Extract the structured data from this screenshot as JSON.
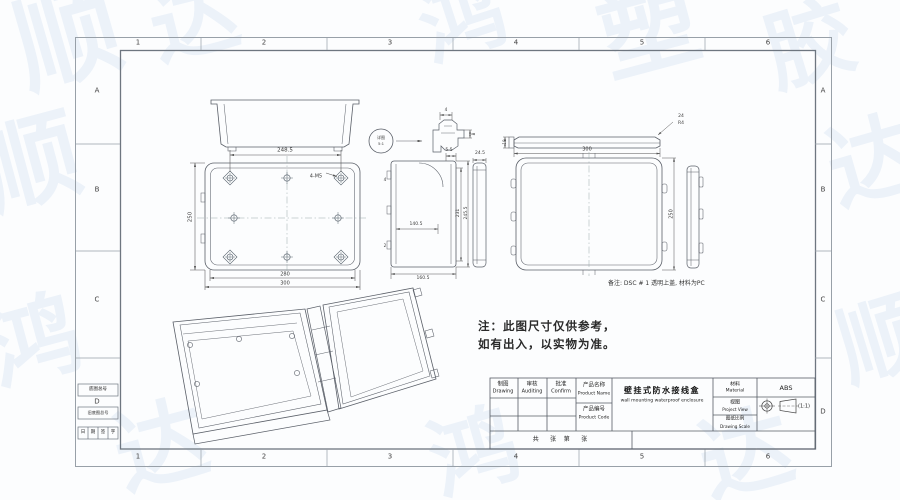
{
  "sheet": {
    "zone_columns": [
      "1",
      "2",
      "3",
      "4",
      "5",
      "6"
    ],
    "zone_rows": [
      "A",
      "B",
      "C",
      "D"
    ],
    "note": {
      "line1": "注：此图尺寸仅供参考，",
      "line2": "如有出入，以实物为准。"
    },
    "remark": "备注: DSC # 1 透明上盖, 材料为PC",
    "side_blocks": {
      "block1": "底图总号",
      "block2": "旧底图总号",
      "sign_row": [
        "日",
        "期",
        "签",
        "字"
      ]
    }
  },
  "title_block": {
    "drawing_cn": "制图",
    "drawing_en": "Drawing",
    "auditing_cn": "审核",
    "auditing_en": "Auditing",
    "confirm_cn": "批准",
    "confirm_en": "Confirm",
    "product_name_cn": "产品名称",
    "product_name_en": "Product Name",
    "product_code_cn": "产品编号",
    "product_code_en": "Product Code",
    "product_name_value_cn": "壁挂式防水接线盒",
    "product_name_value_en": "wall mounting waterproof enclosure",
    "material_cn": "材料",
    "material_en": "Material",
    "material_value": "ABS",
    "view_cn": "视图",
    "view_en": "Project View",
    "scale_cn": "图纸比例",
    "scale_en": "Drawing Scale",
    "scale_value": "(1:1)",
    "sheet_count_row": "共      张    第      张"
  },
  "detail_callout": {
    "label": "详图",
    "scale": "5:1"
  },
  "dimensions": {
    "main_top": "248.5",
    "main_left": "250",
    "main_bottom_inner": "280",
    "main_bottom_outer": "300",
    "main_holes": "4-M5",
    "side_top": "5.5",
    "side_mid": "140.5",
    "side_bottom": "160.5",
    "side_right_inner": "231",
    "side_right_outer": "245.5",
    "side_small_a": "4",
    "side_small_b": "2",
    "strip_top": "24.5",
    "detail_top": "4",
    "detail_right": "8",
    "cover_lip": "18",
    "cover_width": "300",
    "cover_height": "250",
    "cover_leader_a": "24",
    "cover_leader_b": "R4"
  },
  "watermark": {
    "glyphs": [
      "顺",
      "达",
      "鸿",
      "塑",
      "胶",
      "顺",
      "达",
      "鸿",
      "顺",
      "达",
      "鸿",
      "达"
    ]
  }
}
